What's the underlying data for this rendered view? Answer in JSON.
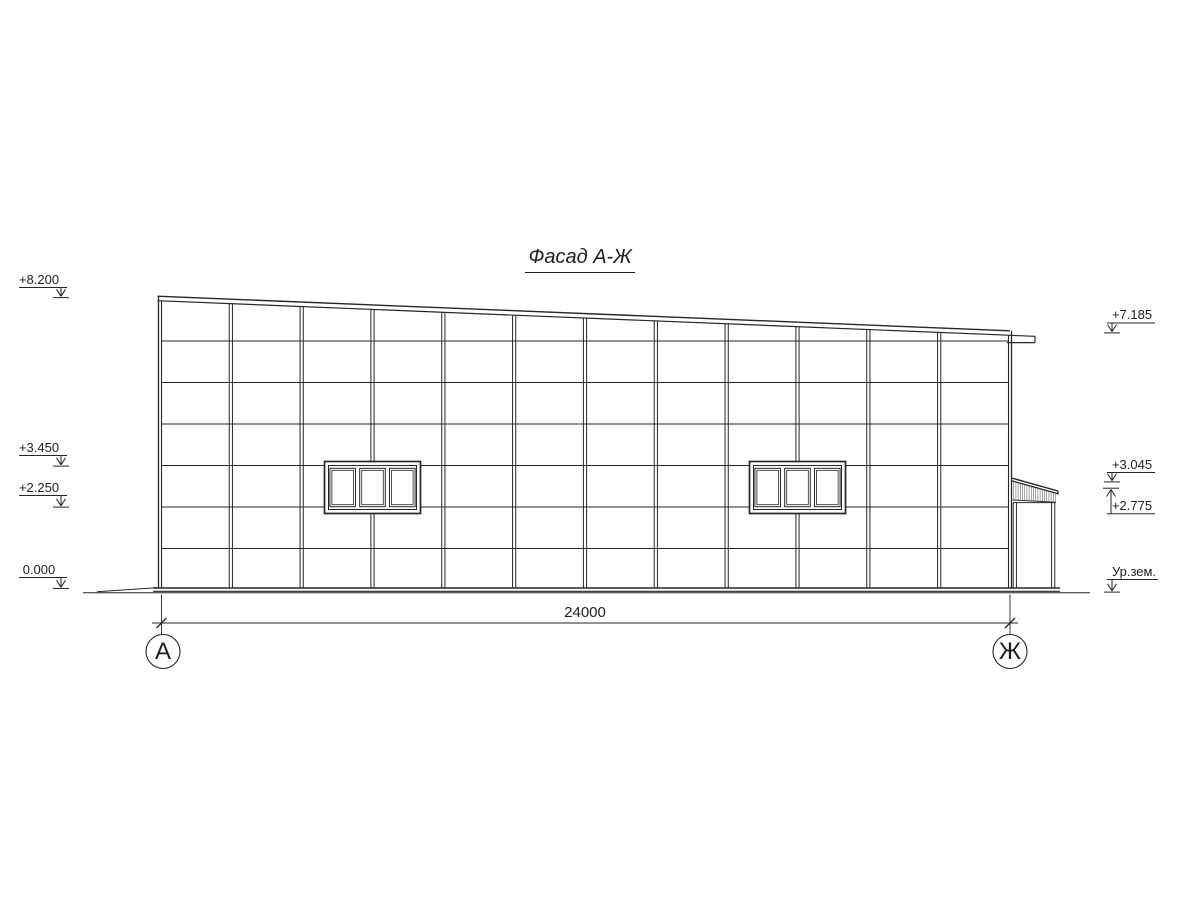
{
  "title": {
    "text": "Фасад А-Ж"
  },
  "dimension": {
    "total_width": "24000"
  },
  "axes": {
    "left_label": "А",
    "right_label": "Ж"
  },
  "elevations": {
    "left": [
      {
        "label": "+8.200"
      },
      {
        "label": "+3.450"
      },
      {
        "label": "+2.250"
      },
      {
        "label": "0.000"
      }
    ],
    "right": [
      {
        "label": "+7.185"
      },
      {
        "label": "+3.045"
      },
      {
        "label": "+2.775"
      },
      {
        "label": "Ур.зем."
      }
    ]
  }
}
